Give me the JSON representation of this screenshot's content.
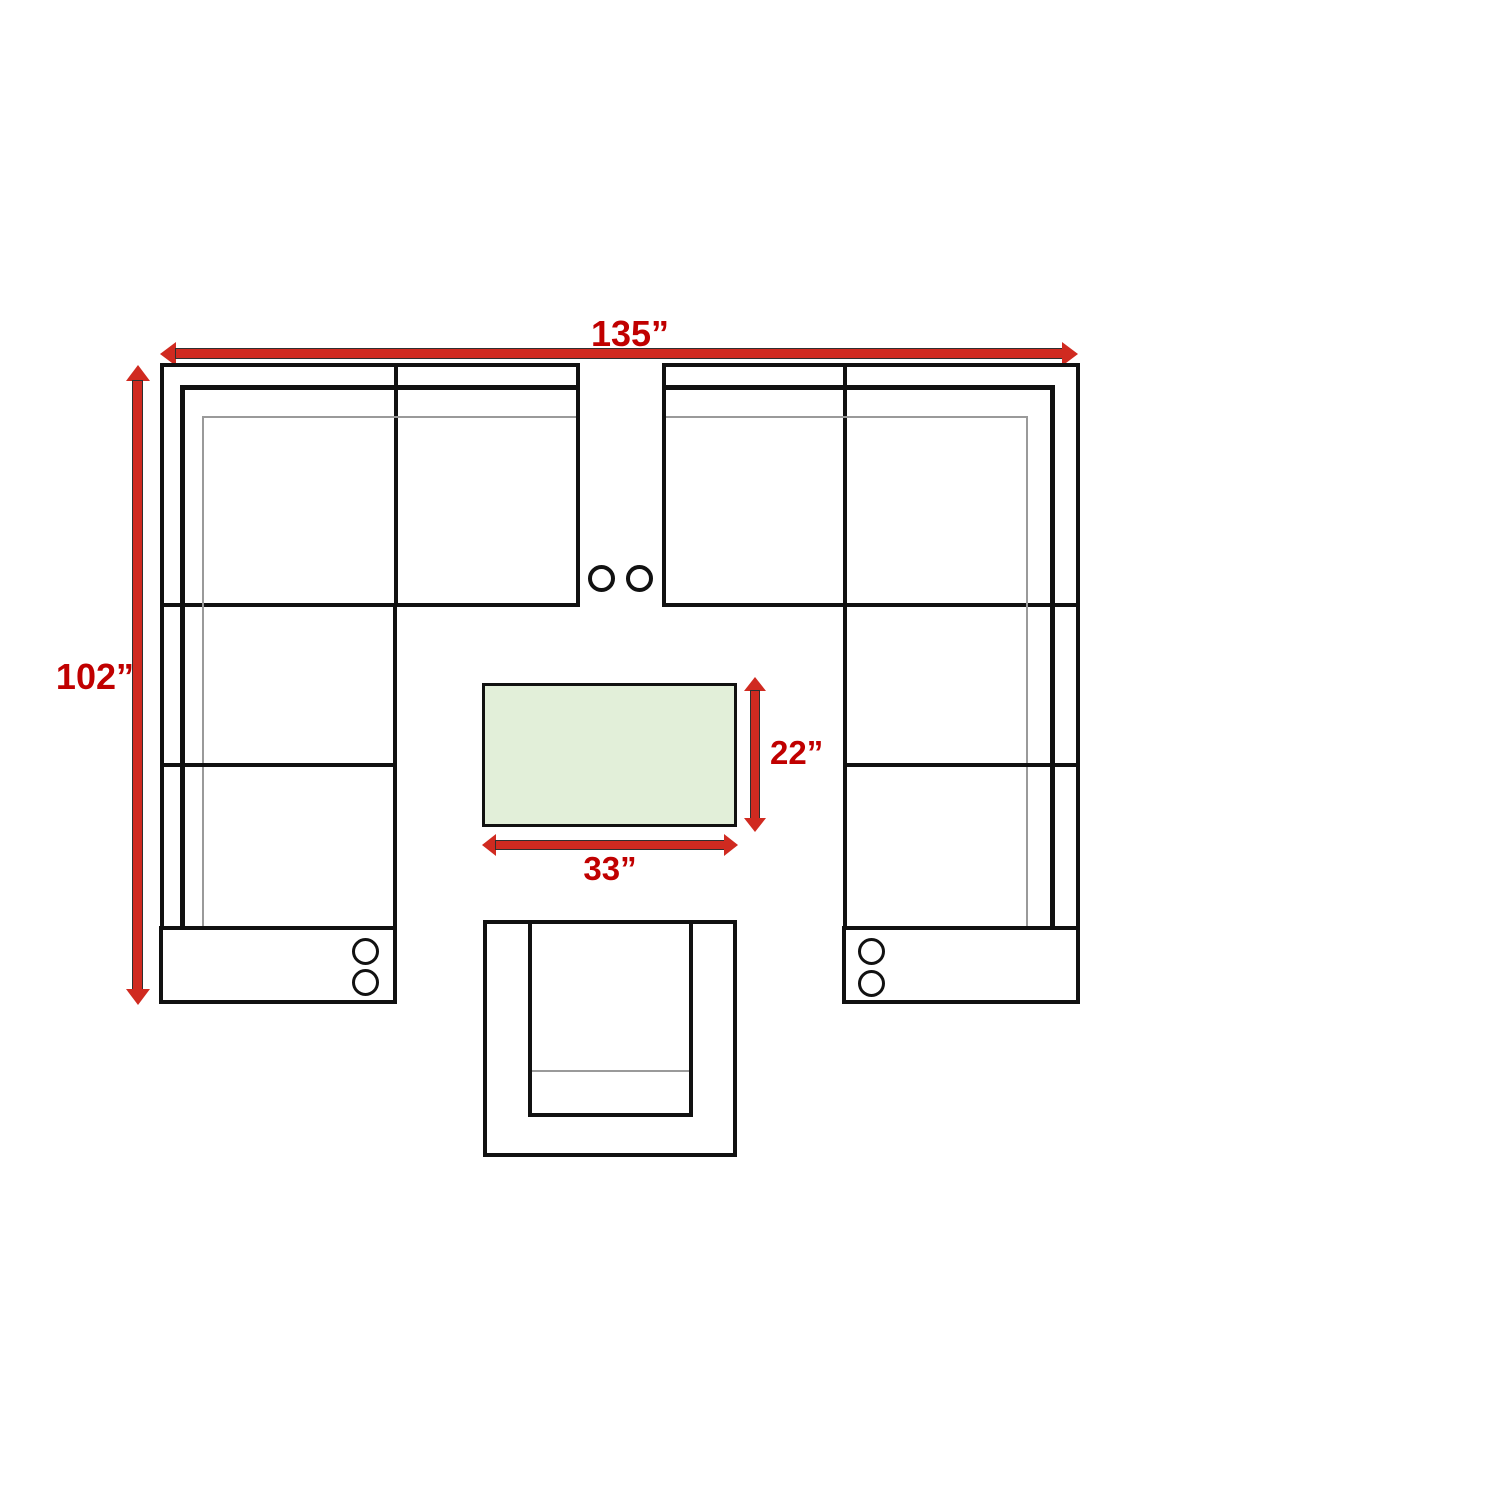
{
  "diagram": {
    "type": "furniture-layout-top-view",
    "colors": {
      "accent_red": "#c00000",
      "arrow_red": "#d02a20",
      "table_green": "#e2efd9",
      "line_black": "#111111",
      "line_gray": "#9a9a9a",
      "background": "#ffffff"
    },
    "dimensions": {
      "overall_width": {
        "label": "135”"
      },
      "overall_depth": {
        "label": "102”"
      },
      "table_depth": {
        "label": "22”"
      },
      "table_width": {
        "label": "33”"
      }
    }
  }
}
